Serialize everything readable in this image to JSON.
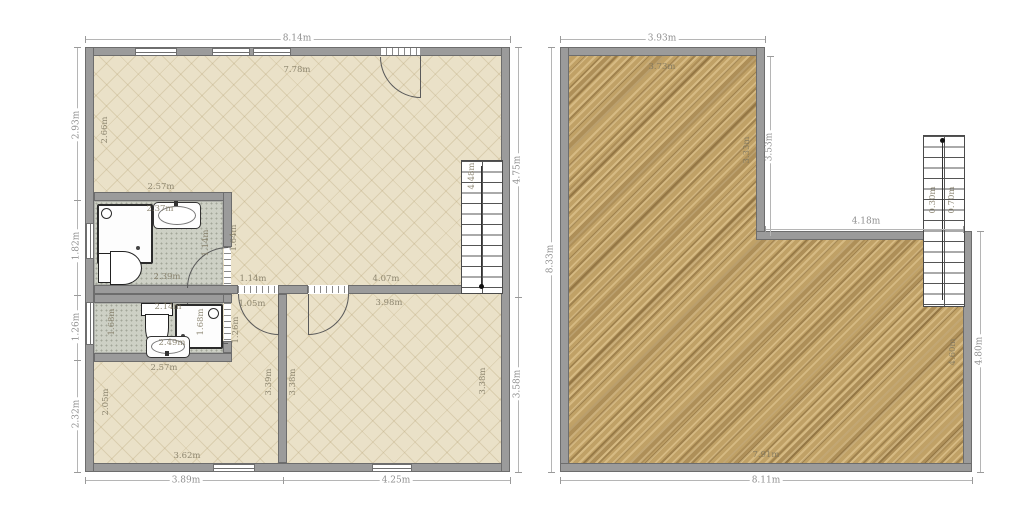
{
  "plans": {
    "left": {
      "exterior_dims": {
        "top": "8.14m",
        "left_1": "2.93m",
        "left_2": "1.82m",
        "left_3": "1.26m",
        "left_4": "2.32m",
        "right_top": "4.75m",
        "right_bottom": "3.58m",
        "bottom_left": "3.89m",
        "bottom_right": "4.25m"
      },
      "interior_dims": {
        "living_top": "7.78m",
        "living_left": "2.66m",
        "living_bottom": "4.07m",
        "hall_width": "1.14m",
        "stairs_height": "4.48m",
        "bath1_width_top": "2.57m",
        "bath1_sink": "2.37m",
        "bath1_bottom": "2.39m",
        "bath1_door": "1.14m",
        "bath1_right": "1.64m",
        "bath2_left": "1.68m",
        "bath2_top": "2.14m",
        "bath2_right": "1.68m",
        "bath2_sink": "2.49m",
        "bath2_below": "2.57m",
        "hall_door": "1.05m",
        "hall_height": "1.26m",
        "room1_left": "2.05m",
        "room1_bottom": "3.62m",
        "room1_right": "3.39m",
        "room2_left": "3.38m",
        "room2_top": "3.98m",
        "room2_right": "3.38m"
      }
    },
    "right": {
      "exterior_dims": {
        "top": "3.93m",
        "left": "8.33m",
        "notch_vertical": "3.53m",
        "notch_horizontal": "4.18m",
        "right": "4.80m",
        "bottom": "8.11m"
      },
      "interior_dims": {
        "top": "3.73m",
        "notch": "3.33m",
        "bottom": "7.91m",
        "right": "4.60m"
      },
      "stairs_dims": {
        "left": "0.30m",
        "right": "0.70m"
      }
    }
  },
  "colors": {
    "wall": "#9b9b9b",
    "parquet": "#eae1c8",
    "tile": "#cdd0c5",
    "wood": "#c0a166",
    "dim_text": "#8f8f8f"
  }
}
